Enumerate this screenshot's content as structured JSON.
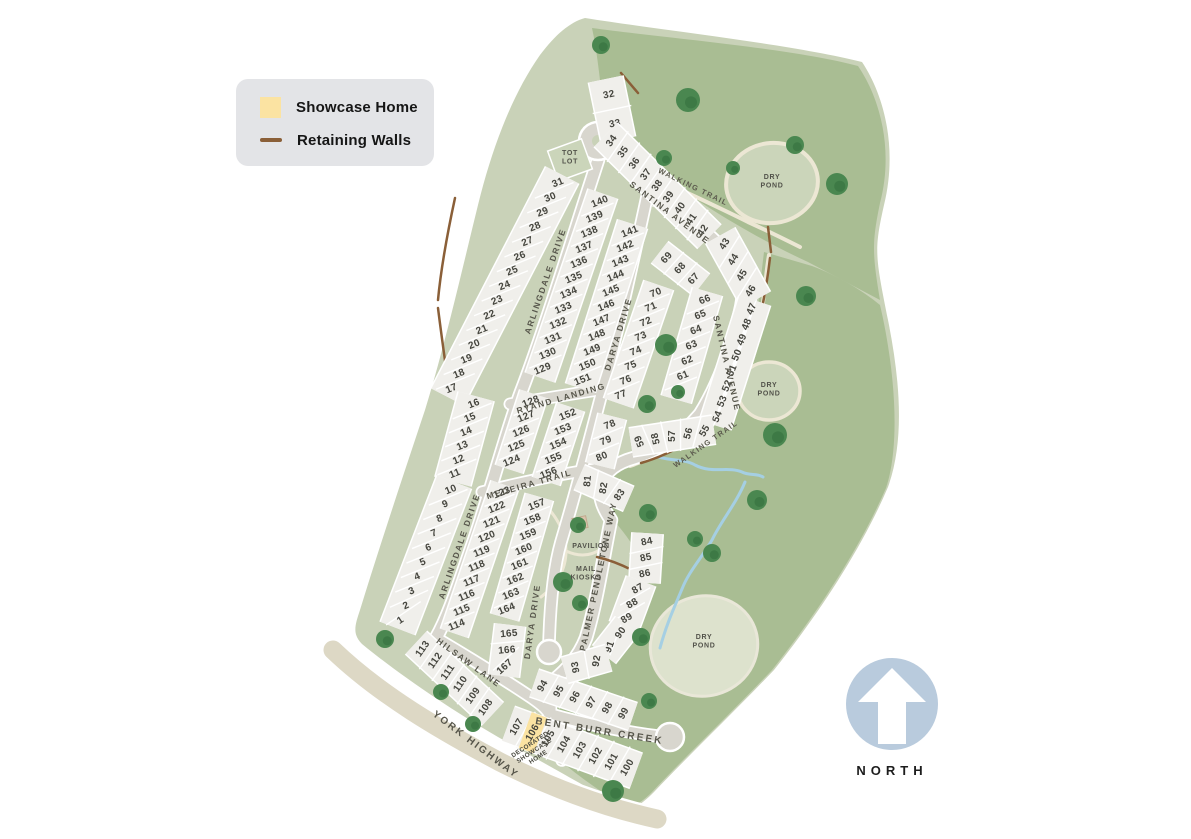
{
  "legend": {
    "items": [
      {
        "swatch": "showcase-square",
        "label": "Showcase Home",
        "color": "#fbe3a2"
      },
      {
        "swatch": "wall-line",
        "label": "Retaining Walls",
        "color": "#8a5f38"
      }
    ]
  },
  "north_arrow": {
    "label": "NORTH",
    "circle_color": "#b9cbdd"
  },
  "colors": {
    "outer_green": "#a9bd93",
    "inner_green": "#c9d2b8",
    "lot_fill": "#f0efeb",
    "road": "#d8d6ce",
    "highway": "#ddd8c5",
    "trail": "#ece7d4",
    "pond_fill": "#cbd5ba",
    "pond_south_fill": "#dde2cd",
    "tree": "#4a8750",
    "tree_dark": "#2f6b3a",
    "wall": "#8a5f38",
    "creek": "#a5cfe3",
    "showcase_fill": "#fbe3a2"
  },
  "site_plan": {
    "lot_rows": [
      {
        "start": [
          609,
          95
        ],
        "step": [
          6,
          29
        ],
        "depth": 34,
        "text_rot": -12,
        "lots": [
          "32",
          "33"
        ]
      },
      {
        "start": [
          612,
          141
        ],
        "step": [
          11.4,
          11.2
        ],
        "depth": 32,
        "text_rot": -55,
        "lots": [
          "34",
          "35",
          "36",
          "37",
          "38",
          "39",
          "40",
          "41",
          "42"
        ]
      },
      {
        "start": [
          558,
          183
        ],
        "step": [
          -7.6,
          14.7
        ],
        "depth": 36,
        "text_rot": -22,
        "lots": [
          "31",
          "30",
          "29",
          "28",
          "27",
          "26",
          "25",
          "24",
          "23",
          "22",
          "21",
          "20",
          "19",
          "18",
          "17"
        ]
      },
      {
        "start": [
          474,
          404
        ],
        "step": [
          -3.8,
          14
        ],
        "depth": 36,
        "text_rot": -22,
        "lots": [
          "16",
          "15",
          "14",
          "13",
          "12",
          "11"
        ]
      },
      {
        "start": [
          451,
          490
        ],
        "step": [
          -5.6,
          14.5
        ],
        "depth": 36,
        "text_rot": -22,
        "text_rots": [
          -22,
          -22,
          -22,
          -22,
          -22,
          -22,
          -22,
          -22,
          -24,
          -34
        ],
        "lots": [
          "10",
          "9",
          "8",
          "7",
          "6",
          "5",
          "4",
          "3",
          "2",
          "1"
        ]
      },
      {
        "start": [
          600,
          202
        ],
        "step": [
          -5.2,
          15.2
        ],
        "depth": 30,
        "text_rot": -22,
        "lots": [
          "140",
          "139",
          "138",
          "137",
          "136",
          "135",
          "134",
          "133",
          "132",
          "131",
          "130",
          "129"
        ]
      },
      {
        "start": [
          630,
          232
        ],
        "step": [
          -4.7,
          14.8
        ],
        "depth": 30,
        "text_rot": -22,
        "lots": [
          "141",
          "142",
          "143",
          "144",
          "145",
          "146",
          "147",
          "148",
          "149",
          "150",
          "151"
        ]
      },
      {
        "start": [
          656,
          293
        ],
        "step": [
          -5,
          14.6
        ],
        "depth": 30,
        "text_rot": -22,
        "lots": [
          "70",
          "71",
          "72",
          "73",
          "74",
          "75",
          "76",
          "77"
        ]
      },
      {
        "start": [
          667,
          258
        ],
        "step": [
          13.5,
          10.5
        ],
        "depth": 26,
        "text_rot": -48,
        "lots": [
          "69",
          "68",
          "67"
        ]
      },
      {
        "start": [
          705,
          300
        ],
        "step": [
          -4.4,
          15.2
        ],
        "depth": 30,
        "text_rot": -22,
        "lots": [
          "66",
          "65",
          "64",
          "63",
          "62",
          "61",
          "60"
        ]
      },
      {
        "start": [
          725,
          244
        ],
        "step": [
          8.7,
          15.7
        ],
        "depth": 32,
        "text_rot": -58,
        "lots": [
          "43",
          "44",
          "45",
          "46"
        ]
      },
      {
        "start": [
          752,
          309
        ],
        "step": [
          -4.9,
          15.4
        ],
        "depth": 32,
        "text_rot": -68,
        "lots": [
          "47",
          "48",
          "49",
          "50",
          "51",
          "52",
          "53",
          "54"
        ]
      },
      {
        "start": [
          705,
          431
        ],
        "step": [
          -16.3,
          2.5
        ],
        "depth": 28,
        "text_rot": -85,
        "text_rots": [
          -60,
          -75,
          -90,
          -103,
          -113
        ],
        "lots": [
          "55",
          "56",
          "57",
          "58",
          "59"
        ]
      },
      {
        "start": [
          610,
          425
        ],
        "step": [
          -4,
          16
        ],
        "depth": 28,
        "text_rot": -22,
        "lots": [
          "78",
          "79",
          "80"
        ]
      },
      {
        "start": [
          588,
          481
        ],
        "step": [
          16,
          7
        ],
        "depth": 26,
        "text_rot": -75,
        "text_rots": [
          -85,
          -80,
          -55
        ],
        "lots": [
          "81",
          "82",
          "83"
        ]
      },
      {
        "start": [
          531,
          402
        ],
        "step": [
          -4.8,
          14.8
        ],
        "depth": 28,
        "text_rot": -22,
        "lots": [
          "128",
          "127",
          "126",
          "125",
          "124"
        ]
      },
      {
        "start": [
          568,
          415
        ],
        "step": [
          -4.8,
          14.6
        ],
        "depth": 28,
        "text_rot": -22,
        "lots": [
          "152",
          "153",
          "154",
          "155",
          "156"
        ]
      },
      {
        "start": [
          502,
          493
        ],
        "step": [
          -5,
          14.7
        ],
        "depth": 28,
        "text_rot": -22,
        "lots": [
          "123",
          "122",
          "121",
          "120",
          "119",
          "118",
          "117",
          "116",
          "115",
          "114"
        ]
      },
      {
        "start": [
          537,
          505
        ],
        "step": [
          -4.3,
          14.9
        ],
        "depth": 28,
        "text_rot": -22,
        "lots": [
          "157",
          "158",
          "159",
          "160",
          "161",
          "162",
          "163",
          "164"
        ]
      },
      {
        "start": [
          509,
          634
        ],
        "step": [
          -2,
          16.5
        ],
        "depth": 30,
        "text_rot": -8,
        "text_rots": [
          -5,
          -5,
          -42
        ],
        "lots": [
          "165",
          "166",
          "167"
        ]
      },
      {
        "start": [
          423,
          649
        ],
        "step": [
          12.6,
          11.7
        ],
        "depth": 30,
        "text_rot": -55,
        "lots": [
          "113",
          "112",
          "111",
          "110",
          "109",
          "108"
        ]
      },
      {
        "start": [
          517,
          727
        ],
        "step": [
          15.8,
          5.8
        ],
        "depth": 36,
        "text_rot": -60,
        "highlight": "106",
        "lots": [
          "107",
          "106",
          "105",
          "104",
          "103",
          "102",
          "101",
          "100"
        ]
      },
      {
        "start": [
          543,
          686
        ],
        "step": [
          16.2,
          5.5
        ],
        "depth": 28,
        "text_rot": -60,
        "lots": [
          "94",
          "95",
          "96",
          "97",
          "98",
          "99"
        ]
      },
      {
        "start": [
          647,
          542
        ],
        "step": [
          -1,
          16
        ],
        "depth": 30,
        "text_rot": -12,
        "lots": [
          "84",
          "85",
          "86"
        ]
      },
      {
        "start": [
          638,
          589
        ],
        "step": [
          -5.5,
          14.8
        ],
        "depth": 30,
        "text_rot": -30,
        "lots": [
          "87",
          "88",
          "89"
        ]
      },
      {
        "start": [
          621,
          633
        ],
        "step": [
          -11,
          14
        ],
        "depth": 28,
        "text_rot": -60,
        "text_rots": [
          -55,
          -70
        ],
        "lots": [
          "90",
          "91"
        ]
      },
      {
        "start": [
          597,
          661
        ],
        "step": [
          -21,
          6
        ],
        "depth": 26,
        "text_rot": -85,
        "text_rots": [
          -80,
          -100
        ],
        "lots": [
          "92",
          "93"
        ]
      }
    ],
    "street_labels": [
      {
        "text": "SANTINA AVENUE",
        "x": 668,
        "y": 215,
        "r": 37
      },
      {
        "text": "SANTINA AVENUE",
        "x": 724,
        "y": 364,
        "r": 77
      },
      {
        "text": "ARLINGDALE DRIVE",
        "x": 548,
        "y": 282,
        "r": -71
      },
      {
        "text": "ARLINGDALE DRIVE",
        "x": 462,
        "y": 547,
        "r": -71
      },
      {
        "text": "DARYA DRIVE",
        "x": 621,
        "y": 335,
        "r": -73
      },
      {
        "text": "DARYA DRIVE",
        "x": 535,
        "y": 622,
        "r": -82
      },
      {
        "text": "RYAND LANDING",
        "x": 562,
        "y": 401,
        "r": -16
      },
      {
        "text": "MEDEIRA TRAIL",
        "x": 530,
        "y": 487,
        "r": -16
      },
      {
        "text": "PALMER PENDLETONE WAY",
        "x": 601,
        "y": 577,
        "r": -78
      },
      {
        "text": "HILSAW LANE",
        "x": 467,
        "y": 665,
        "r": 36
      },
      {
        "text": "YORK HIGHWAY",
        "x": 474,
        "y": 747,
        "r": 37,
        "size": "big"
      },
      {
        "text": "BENT BURR CREEK",
        "x": 599,
        "y": 734,
        "r": 9,
        "size": "big"
      },
      {
        "text": "WALKING TRAIL",
        "x": 692,
        "y": 189,
        "r": 26,
        "size": "small"
      },
      {
        "text": "WALKING TRAIL",
        "x": 707,
        "y": 446,
        "r": -35,
        "size": "small"
      }
    ],
    "area_labels": [
      {
        "name": "dry-pond-north-label",
        "lines": [
          "DRY",
          "POND"
        ],
        "x": 772,
        "y": 179
      },
      {
        "name": "dry-pond-middle-label",
        "lines": [
          "DRY",
          "POND"
        ],
        "x": 769,
        "y": 387
      },
      {
        "name": "dry-pond-south-label",
        "lines": [
          "DRY",
          "POND"
        ],
        "x": 704,
        "y": 639
      },
      {
        "name": "tot-lot-label",
        "lines": [
          "TOT",
          "LOT"
        ],
        "x": 570,
        "y": 155
      },
      {
        "name": "pavilion-label",
        "lines": [
          "PAVILION"
        ],
        "x": 591,
        "y": 548
      },
      {
        "name": "mail-kiosks-label",
        "lines": [
          "MAIL",
          "KIOSKS"
        ],
        "x": 586,
        "y": 571
      }
    ],
    "showcase_callout": {
      "lines": [
        "DECORATED",
        "SHOWCASE",
        "HOME"
      ],
      "x": 531,
      "y": 746,
      "r": -33
    },
    "trees": [
      [
        601,
        45,
        9
      ],
      [
        688,
        100,
        12
      ],
      [
        664,
        158,
        8
      ],
      [
        733,
        168,
        7
      ],
      [
        795,
        145,
        9
      ],
      [
        837,
        184,
        11
      ],
      [
        806,
        296,
        10
      ],
      [
        666,
        345,
        11
      ],
      [
        647,
        404,
        9
      ],
      [
        678,
        392,
        7
      ],
      [
        775,
        435,
        12
      ],
      [
        757,
        500,
        10
      ],
      [
        695,
        539,
        8
      ],
      [
        712,
        553,
        9
      ],
      [
        648,
        513,
        9
      ],
      [
        578,
        525,
        8
      ],
      [
        563,
        582,
        10
      ],
      [
        580,
        603,
        8
      ],
      [
        641,
        637,
        9
      ],
      [
        649,
        701,
        8
      ],
      [
        613,
        791,
        11
      ],
      [
        385,
        639,
        9
      ],
      [
        441,
        692,
        8
      ],
      [
        473,
        724,
        8
      ]
    ]
  }
}
